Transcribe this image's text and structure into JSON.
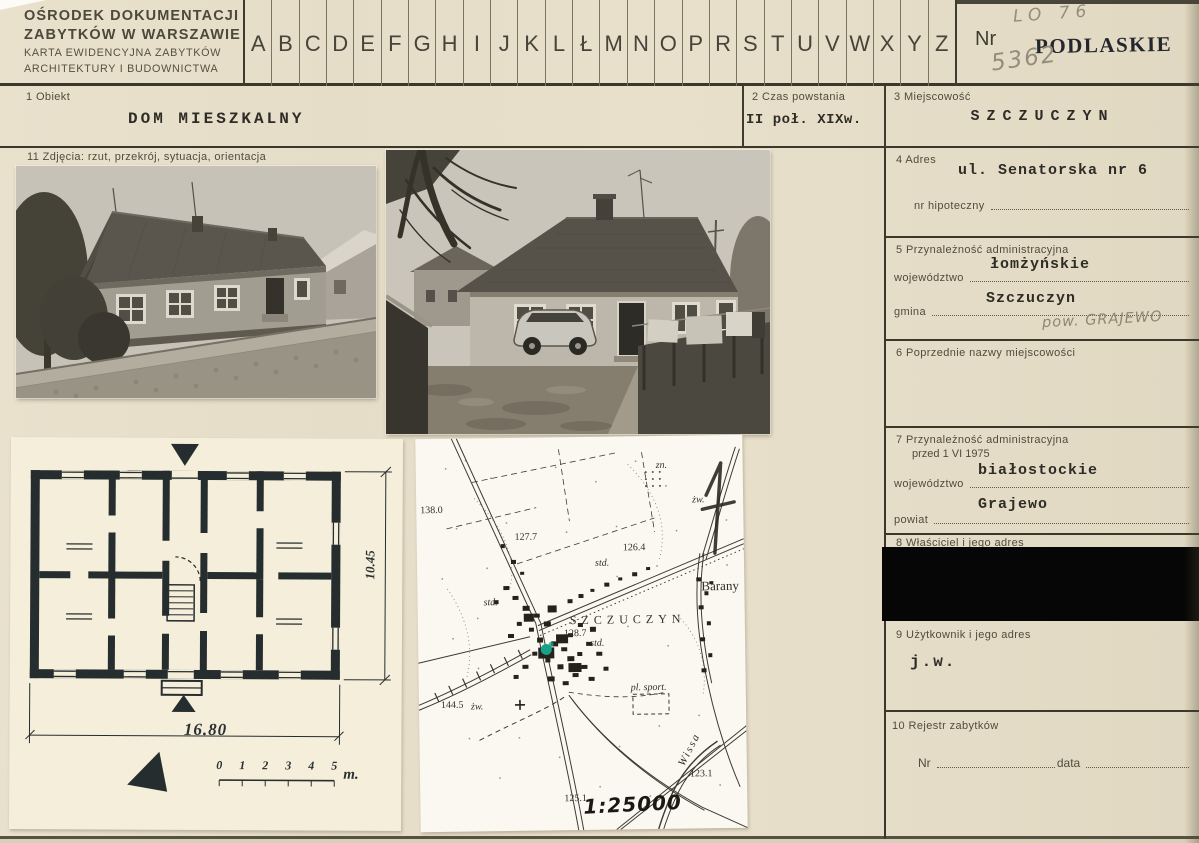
{
  "colors": {
    "paper": "#e7dfca",
    "plan_paper": "#f5eeda",
    "map_paper": "#faf8f1",
    "ink": "#3b372b",
    "stamp_ink": "#23262e",
    "pencil": "#958d7b",
    "marker_green": "#17a189"
  },
  "header": {
    "institution_line1": "OŚRODEK DOKUMENTACJI",
    "institution_line2": "ZABYTKÓW W WARSZAWIE",
    "institution_line3": "KARTA EWIDENCYJNA ZABYTKÓW",
    "institution_line4": "ARCHITEKTURY I BUDOWNICTWA",
    "alphabet": [
      "A",
      "B",
      "C",
      "D",
      "E",
      "F",
      "G",
      "H",
      "I",
      "J",
      "K",
      "L",
      "Ł",
      "M",
      "N",
      "O",
      "P",
      "R",
      "S",
      "T",
      "U",
      "V",
      "W",
      "X",
      "Y",
      "Z"
    ],
    "nr_label": "Nr",
    "region_stamp": "PODLASKIE",
    "handwritten_code_top": "LO 76",
    "handwritten_code_bottom": "5362"
  },
  "fields": {
    "f1": {
      "label": "1  Obiekt",
      "value": "DOM  MIESZKALNY"
    },
    "f2": {
      "label": "2  Czas powstania",
      "value": "II poł. XIXw."
    },
    "f3": {
      "label": "3  Miejscowość",
      "value": "SZCZUCZYN"
    },
    "f4": {
      "label": "4  Adres",
      "value": "ul. Senatorska nr 6",
      "sub_label": "nr hipoteczny"
    },
    "f5": {
      "label": "5  Przynależność administracyjna",
      "wojewodztwo_label": "województwo",
      "wojewodztwo_value": "łomżyńskie",
      "gmina_label": "gmina",
      "gmina_value": "Szczuczyn",
      "handwritten_note": "pow. GRAJEWO"
    },
    "f6": {
      "label": "6  Poprzednie nazwy miejscowości"
    },
    "f7": {
      "label": "7  Przynależność administracyjna",
      "label2": "przed 1 VI 1975",
      "wojewodztwo_label": "województwo",
      "wojewodztwo_value": "białostockie",
      "powiat_label": "powiat",
      "powiat_value": "Grajewo"
    },
    "f8": {
      "label": "8  Właściciel i jego adres"
    },
    "f9": {
      "label": "9  Użytkownik i jego adres",
      "value": "j.w."
    },
    "f10": {
      "label": "10  Rejestr zabytków",
      "nr_label": "Nr",
      "data_label": "data"
    },
    "f11": {
      "label": "11  Zdjęcia: rzut, przekrój, sytuacja, orientacja"
    }
  },
  "plan": {
    "width_dim": "16.80",
    "height_dim": "10.45",
    "scale_ticks": [
      "0",
      "1",
      "2",
      "3",
      "4",
      "5"
    ],
    "scale_unit": "m."
  },
  "map": {
    "scale_note": "1:25000",
    "labels": [
      {
        "text": "138.0",
        "x": 4,
        "y": 66
      },
      {
        "text": "127.7",
        "x": 98,
        "y": 94
      },
      {
        "text": "126.4",
        "x": 206,
        "y": 106
      },
      {
        "text": "std.",
        "x": 178,
        "y": 121,
        "cls": "it"
      },
      {
        "text": "zn.",
        "x": 240,
        "y": 24,
        "cls": "it"
      },
      {
        "text": "żw.",
        "x": 276,
        "y": 59,
        "cls": "it"
      },
      {
        "text": "Barany",
        "x": 284,
        "y": 143,
        "cls": "big"
      },
      {
        "text": "std.",
        "x": 66,
        "y": 159,
        "cls": "it"
      },
      {
        "text": "SZCZUCZYN",
        "x": 152,
        "y": 176,
        "cls": "town"
      },
      {
        "text": "128.7",
        "x": 146,
        "y": 191
      },
      {
        "text": "std.",
        "x": 172,
        "y": 201,
        "cls": "it"
      },
      {
        "text": "144.5",
        "x": 22,
        "y": 261
      },
      {
        "text": "żw.",
        "x": 52,
        "y": 263,
        "cls": "it"
      },
      {
        "text": "pl. sport.",
        "x": 212,
        "y": 246,
        "cls": "it"
      },
      {
        "text": "Wissa",
        "x": 252,
        "y": 308,
        "cls": "river"
      },
      {
        "text": "123.1",
        "x": 270,
        "y": 333
      },
      {
        "text": "125.1",
        "x": 144,
        "y": 356
      }
    ]
  }
}
